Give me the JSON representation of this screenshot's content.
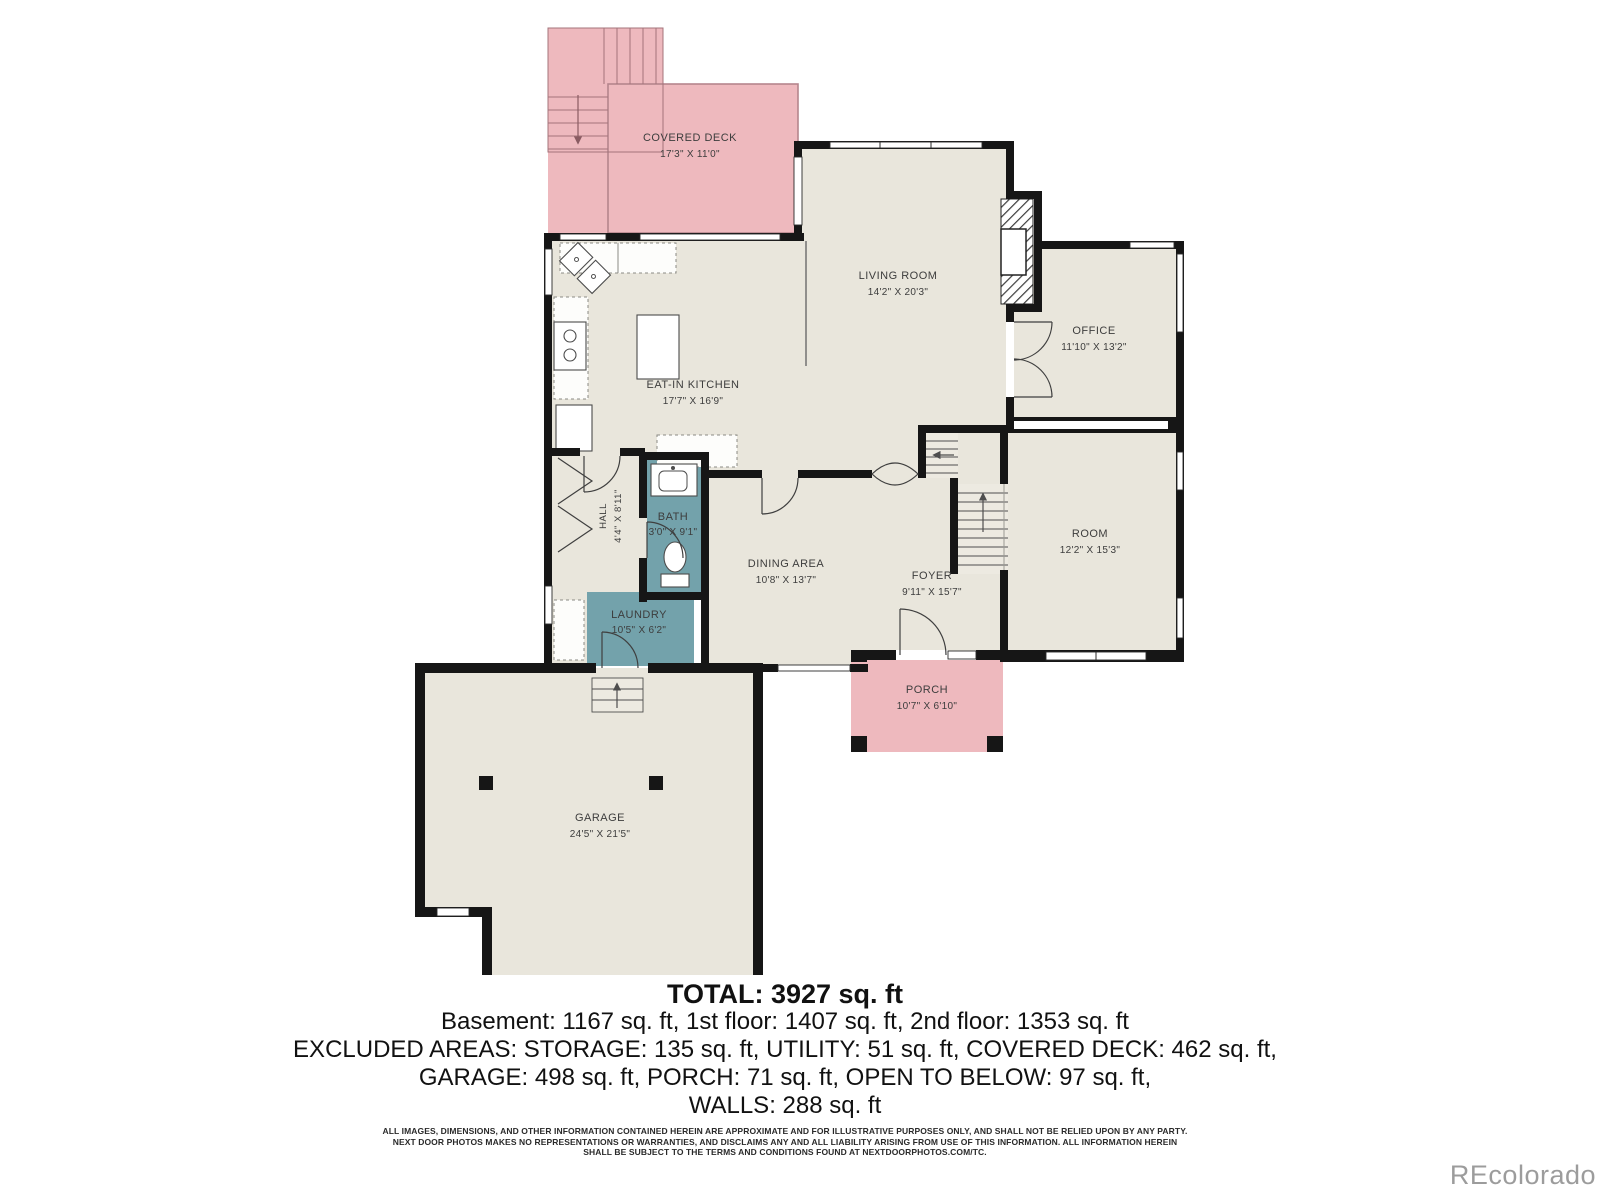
{
  "plan": {
    "rooms": {
      "covered_deck": {
        "name": "COVERED DECK",
        "dims": "17'3\" X 11'0\""
      },
      "living_room": {
        "name": "LIVING ROOM",
        "dims": "14'2\" X 20'3\""
      },
      "office": {
        "name": "OFFICE",
        "dims": "11'10\" X 13'2\""
      },
      "eat_in_kitchen": {
        "name": "EAT-IN KITCHEN",
        "dims": "17'7\" X 16'9\""
      },
      "hall": {
        "name": "HALL",
        "dims": "4'4\" X 8'11\""
      },
      "bath": {
        "name": "BATH",
        "dims": "3'0\" X 9'1\""
      },
      "dining_area": {
        "name": "DINING AREA",
        "dims": "10'8\" X 13'7\""
      },
      "foyer": {
        "name": "FOYER",
        "dims": "9'11\" X 15'7\""
      },
      "room": {
        "name": "ROOM",
        "dims": "12'2\" X 15'3\""
      },
      "laundry": {
        "name": "LAUNDRY",
        "dims": "10'5\" X 6'2\""
      },
      "porch": {
        "name": "PORCH",
        "dims": "10'7\" X 6'10\""
      },
      "garage": {
        "name": "GARAGE",
        "dims": "24'5\" X 21'5\""
      }
    }
  },
  "summary": {
    "total": "TOTAL: 3927 sq. ft",
    "floors": "Basement: 1167 sq. ft, 1st floor: 1407 sq. ft, 2nd floor: 1353 sq. ft",
    "excluded1": "EXCLUDED AREAS: STORAGE: 135 sq. ft, UTILITY: 51 sq. ft, COVERED DECK: 462 sq. ft,",
    "excluded2": "GARAGE: 498 sq. ft, PORCH: 71 sq. ft, OPEN TO BELOW: 97 sq. ft,",
    "walls": "WALLS: 288 sq. ft"
  },
  "disclaimer": {
    "line1": "ALL IMAGES, DIMENSIONS, AND OTHER INFORMATION CONTAINED HEREIN ARE APPROXIMATE AND FOR ILLUSTRATIVE PURPOSES ONLY, AND SHALL NOT BE RELIED UPON BY ANY PARTY.",
    "line2": "NEXT DOOR PHOTOS MAKES NO REPRESENTATIONS OR WARRANTIES, AND DISCLAIMS ANY AND ALL LIABILITY ARISING FROM USE OF THIS INFORMATION. ALL INFORMATION HEREIN",
    "line3": "SHALL BE SUBJECT TO THE TERMS AND CONDITIONS FOUND AT NEXTDOORPHOTOS.COM/TC."
  },
  "watermark": "REcolorado",
  "colors": {
    "floor": "#e9e6dc",
    "wall": "#161616",
    "deck_porch_pink": "#eeb9be",
    "wet_room_teal": "#73a2ab",
    "watermark_gray": "#9c9c9c"
  }
}
